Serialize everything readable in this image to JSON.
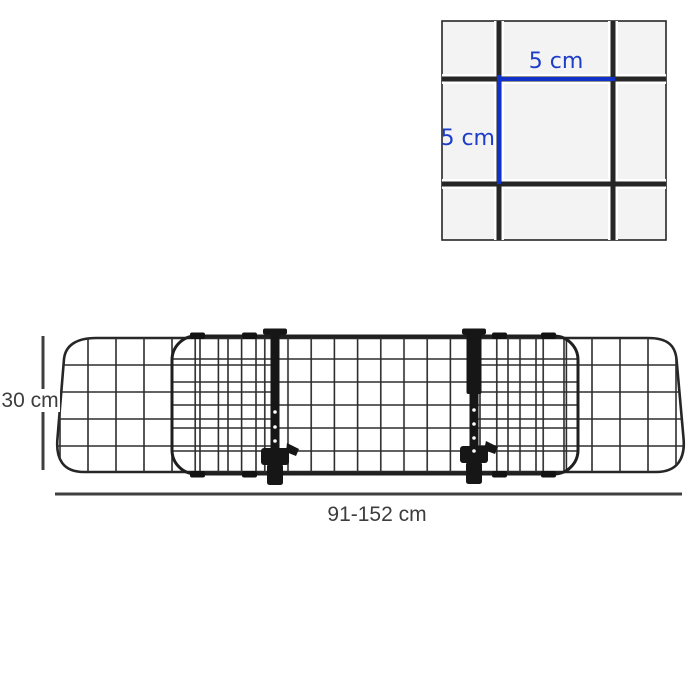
{
  "labels": {
    "cell_width": "5 cm",
    "cell_height": "5 cm",
    "barrier_height": "30 cm",
    "barrier_width": "91-152 cm"
  },
  "colors": {
    "accent-text": "#1d3cc8",
    "accent-line": "#1132c8",
    "dim-line": "#3f3f3f",
    "dim-text": "#3d3d3d",
    "frame": "#262626",
    "panel": "#1f1f1f",
    "mesh": "#2d2d2d",
    "wire": "#262626",
    "metal": "#161616",
    "cell-fill": "#f3f3f3",
    "background": "#ffffff"
  }
}
